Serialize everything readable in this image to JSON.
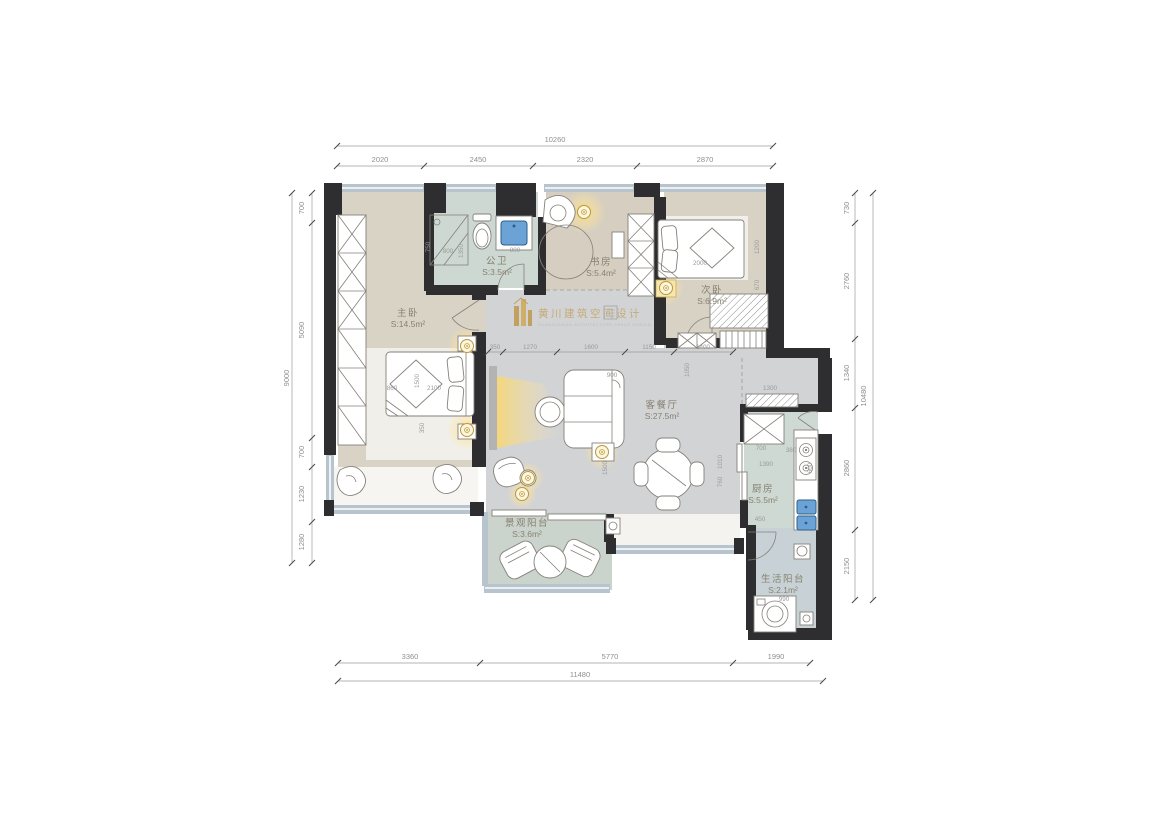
{
  "plan": {
    "logo": {
      "brand": "黄川建筑空间设计",
      "subtitle": "HUANGCHUAN ARCHITECTURE SPACE DESIGN"
    },
    "accent_colors": {
      "wall": "#2e2e30",
      "glow": "#f5c842",
      "gold": "#c0984b",
      "water_blue": "#6ba3d6",
      "window_band": "#b7c4cd"
    }
  },
  "rooms": [
    {
      "id": "master-bedroom",
      "name": "主卧",
      "area": "S:14.5m²",
      "cx": 408,
      "cy": 316
    },
    {
      "id": "public-bathroom",
      "name": "公卫",
      "area": "S:3.5m²",
      "cx": 497,
      "cy": 264
    },
    {
      "id": "study",
      "name": "书房",
      "area": "S:5.4m²",
      "cx": 601,
      "cy": 265
    },
    {
      "id": "second-bedroom",
      "name": "次卧",
      "area": "S:6.9m²",
      "cx": 712,
      "cy": 293
    },
    {
      "id": "living-dining",
      "name": "客餐厅",
      "area": "S:27.5m²",
      "cx": 662,
      "cy": 408
    },
    {
      "id": "kitchen",
      "name": "厨房",
      "area": "S:5.5m²",
      "cx": 763,
      "cy": 492
    },
    {
      "id": "view-balcony",
      "name": "景观阳台",
      "area": "S:3.6m²",
      "cx": 527,
      "cy": 526
    },
    {
      "id": "life-balcony",
      "name": "生活阳台",
      "area": "S:2.1m²",
      "cx": 783,
      "cy": 582
    }
  ],
  "dimensions": [
    {
      "t": "10260",
      "x": 555,
      "y": 142
    },
    {
      "t": "2020",
      "x": 380,
      "y": 162
    },
    {
      "t": "2450",
      "x": 478,
      "y": 162
    },
    {
      "t": "2320",
      "x": 585,
      "y": 162
    },
    {
      "t": "2870",
      "x": 705,
      "y": 162
    },
    {
      "t": "9000",
      "x": 289,
      "y": 378,
      "v": 1
    },
    {
      "t": "700",
      "x": 304,
      "y": 208,
      "v": 1
    },
    {
      "t": "5090",
      "x": 304,
      "y": 330,
      "v": 1
    },
    {
      "t": "700",
      "x": 304,
      "y": 452,
      "v": 1
    },
    {
      "t": "1230",
      "x": 304,
      "y": 494,
      "v": 1
    },
    {
      "t": "1280",
      "x": 304,
      "y": 542,
      "v": 1
    },
    {
      "t": "730",
      "x": 849,
      "y": 208,
      "v": 1
    },
    {
      "t": "2760",
      "x": 849,
      "y": 281,
      "v": 1
    },
    {
      "t": "1340",
      "x": 849,
      "y": 373,
      "v": 1
    },
    {
      "t": "2860",
      "x": 849,
      "y": 468,
      "v": 1
    },
    {
      "t": "2150",
      "x": 849,
      "y": 566,
      "v": 1
    },
    {
      "t": "10480",
      "x": 866,
      "y": 396,
      "v": 1
    },
    {
      "t": "3360",
      "x": 410,
      "y": 659
    },
    {
      "t": "5770",
      "x": 610,
      "y": 659
    },
    {
      "t": "1990",
      "x": 776,
      "y": 659
    },
    {
      "t": "11480",
      "x": 580,
      "y": 677
    },
    {
      "t": "350",
      "x": 495,
      "y": 349,
      "s": 1
    },
    {
      "t": "1270",
      "x": 530,
      "y": 349,
      "s": 1
    },
    {
      "t": "1600",
      "x": 591,
      "y": 349,
      "s": 1
    },
    {
      "t": "1150",
      "x": 649,
      "y": 349,
      "s": 1
    },
    {
      "t": "1400",
      "x": 703,
      "y": 349,
      "s": 1
    },
    {
      "t": "900",
      "x": 612,
      "y": 377,
      "s": 1
    },
    {
      "t": "1500",
      "x": 607,
      "y": 468,
      "v": 1,
      "s": 1
    },
    {
      "t": "1010",
      "x": 722,
      "y": 462,
      "v": 1,
      "s": 1
    },
    {
      "t": "760",
      "x": 722,
      "y": 482,
      "v": 1,
      "s": 1
    },
    {
      "t": "860",
      "x": 392,
      "y": 390,
      "s": 1
    },
    {
      "t": "2100",
      "x": 434,
      "y": 390,
      "s": 1
    },
    {
      "t": "1500",
      "x": 419,
      "y": 381,
      "v": 1,
      "s": 1
    },
    {
      "t": "350",
      "x": 424,
      "y": 428,
      "v": 1,
      "s": 1
    },
    {
      "t": "2000",
      "x": 700,
      "y": 265,
      "s": 1
    },
    {
      "t": "1200",
      "x": 759,
      "y": 247,
      "v": 1,
      "s": 1
    },
    {
      "t": "670",
      "x": 759,
      "y": 285,
      "v": 1,
      "s": 1
    },
    {
      "t": "750",
      "x": 430,
      "y": 247,
      "v": 1,
      "s": 1
    },
    {
      "t": "800",
      "x": 448,
      "y": 253,
      "s": 1
    },
    {
      "t": "1350",
      "x": 463,
      "y": 251,
      "v": 1,
      "s": 1
    },
    {
      "t": "800",
      "x": 515,
      "y": 252,
      "s": 1
    },
    {
      "t": "1300",
      "x": 770,
      "y": 390,
      "s": 1
    },
    {
      "t": "700",
      "x": 761,
      "y": 450,
      "s": 1
    },
    {
      "t": "1050",
      "x": 689,
      "y": 370,
      "v": 1,
      "s": 1
    },
    {
      "t": "1390",
      "x": 766,
      "y": 466,
      "s": 1
    },
    {
      "t": "380",
      "x": 791,
      "y": 452,
      "s": 1
    },
    {
      "t": "600",
      "x": 812,
      "y": 468,
      "v": 1,
      "s": 1
    },
    {
      "t": "450",
      "x": 760,
      "y": 521,
      "s": 1
    },
    {
      "t": "990",
      "x": 784,
      "y": 601,
      "s": 1
    }
  ]
}
